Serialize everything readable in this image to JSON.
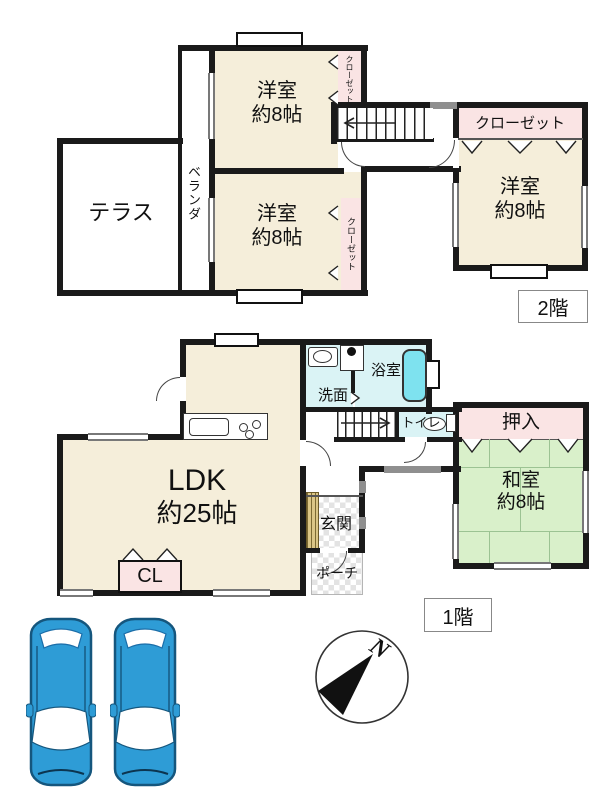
{
  "floor2": {
    "badge": "2階",
    "terrace": "テラス",
    "veranda": "ベランダ",
    "room_nw": {
      "name": "洋室",
      "size": "約8帖"
    },
    "room_sw": {
      "name": "洋室",
      "size": "約8帖"
    },
    "room_e": {
      "name": "洋室",
      "size": "約8帖"
    },
    "closet_nw": "クローゼット",
    "closet_sw": "クローゼット",
    "closet_e": "クローゼット"
  },
  "floor1": {
    "badge": "1階",
    "ldk": {
      "name": "LDK",
      "size": "約25帖"
    },
    "washroom": "洗面",
    "bathroom": "浴室",
    "toilet": "トイレ",
    "oshiire": "押入",
    "washitsu": {
      "name": "和室",
      "size": "約8帖"
    },
    "entrance": "玄関",
    "porch": "ポーチ",
    "closet": "CL"
  },
  "compass": {
    "north": "N"
  },
  "parking": {
    "car_count": 2
  },
  "colors": {
    "room_cream": "#F5EEDA",
    "closet_pink": "#FAE4E4",
    "tatami_green": "#D9F0CA",
    "wet_blue": "#DAF3F5",
    "tub_cyan": "#7EE2EF",
    "car_blue": "#2E9CD6",
    "entrance_wood": "#DBC687",
    "wall": "#1A1A1A"
  }
}
